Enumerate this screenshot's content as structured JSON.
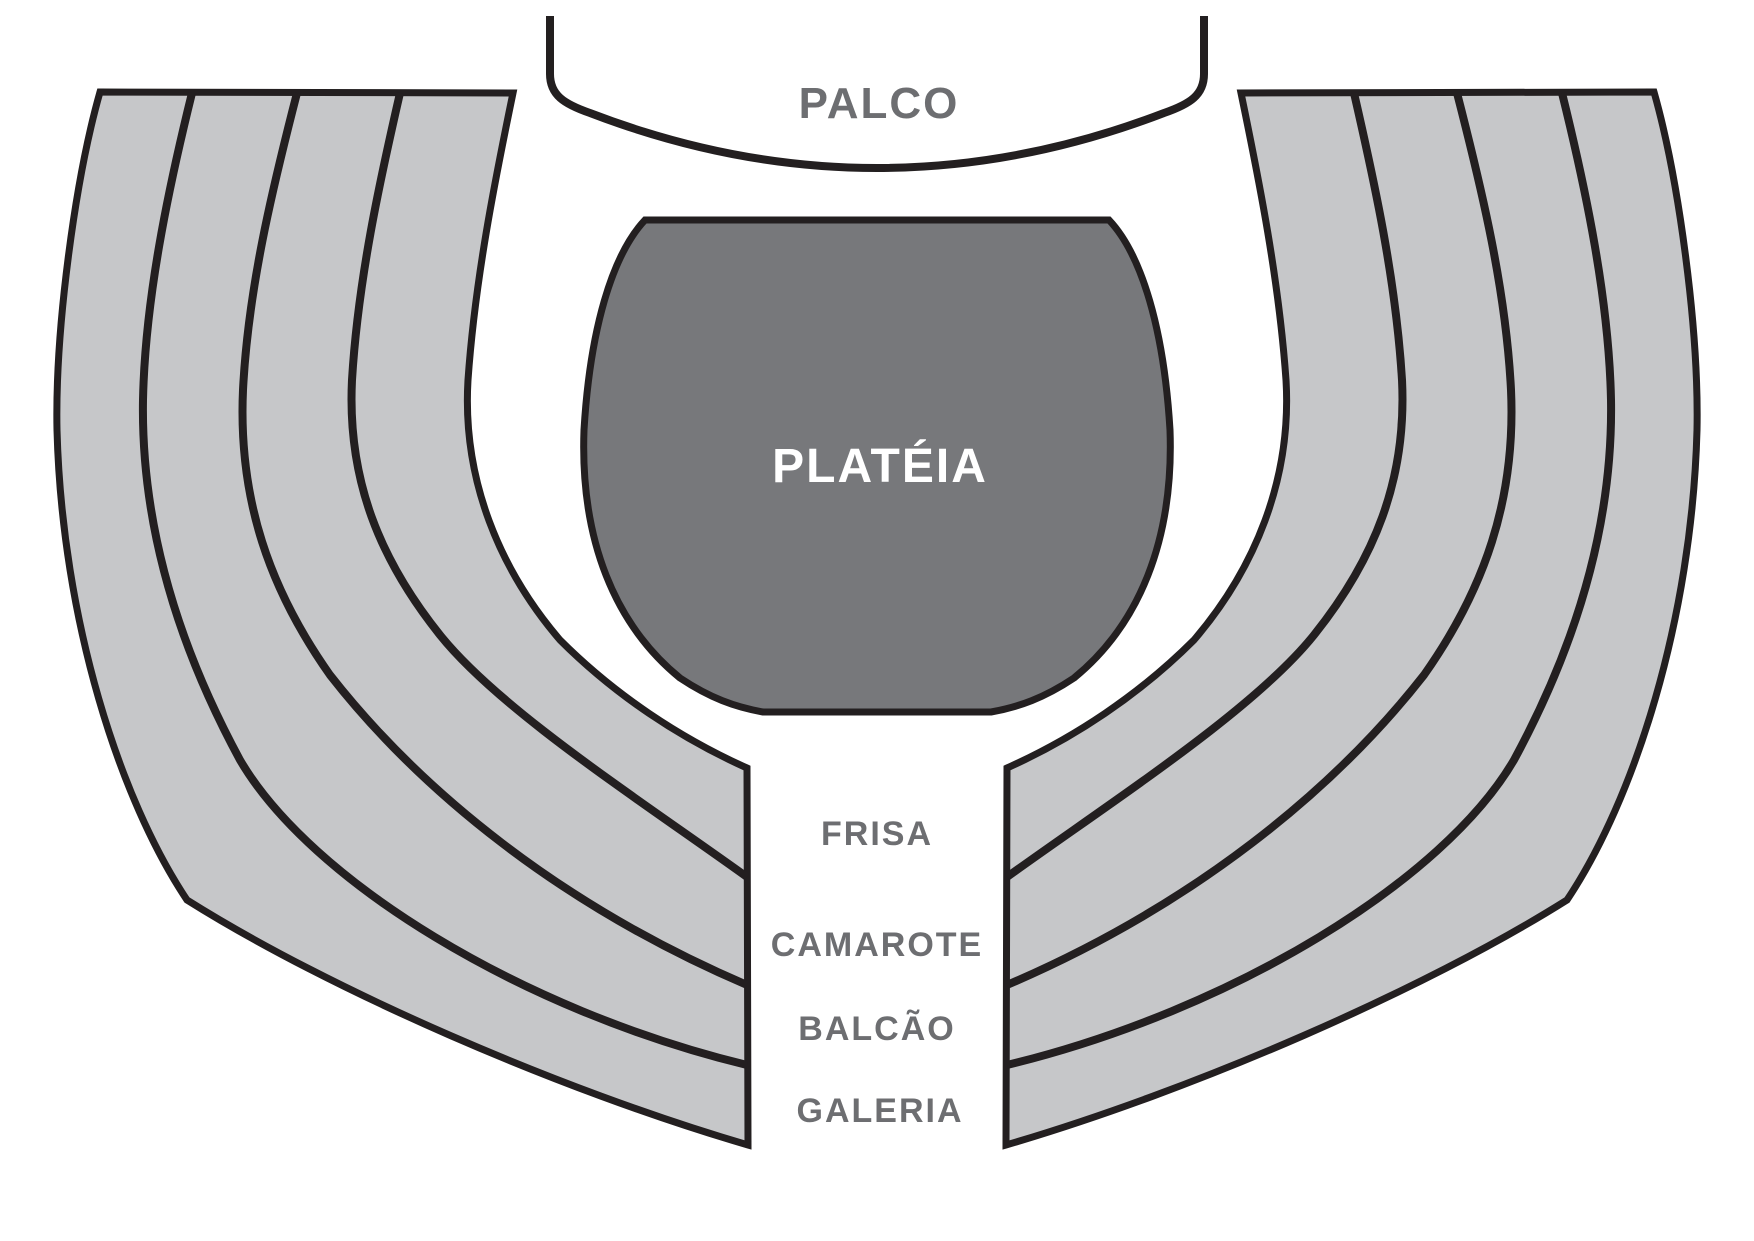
{
  "diagram": {
    "stage": {
      "label": "PALCO"
    },
    "audience": {
      "label": "PLATÉIA"
    },
    "levels": [
      {
        "id": "frisa",
        "label": "FRISA"
      },
      {
        "id": "camarote",
        "label": "CAMAROTE"
      },
      {
        "id": "balcao",
        "label": "BALCÃO"
      },
      {
        "id": "galeria",
        "label": "GALERIA"
      }
    ],
    "colors": {
      "band": "#c6c7c9",
      "outline": "#231f20",
      "audience": "#77787b",
      "label-gray": "#6d6e71",
      "label-on-dark": "#ffffff",
      "bg": "#ffffff"
    }
  }
}
